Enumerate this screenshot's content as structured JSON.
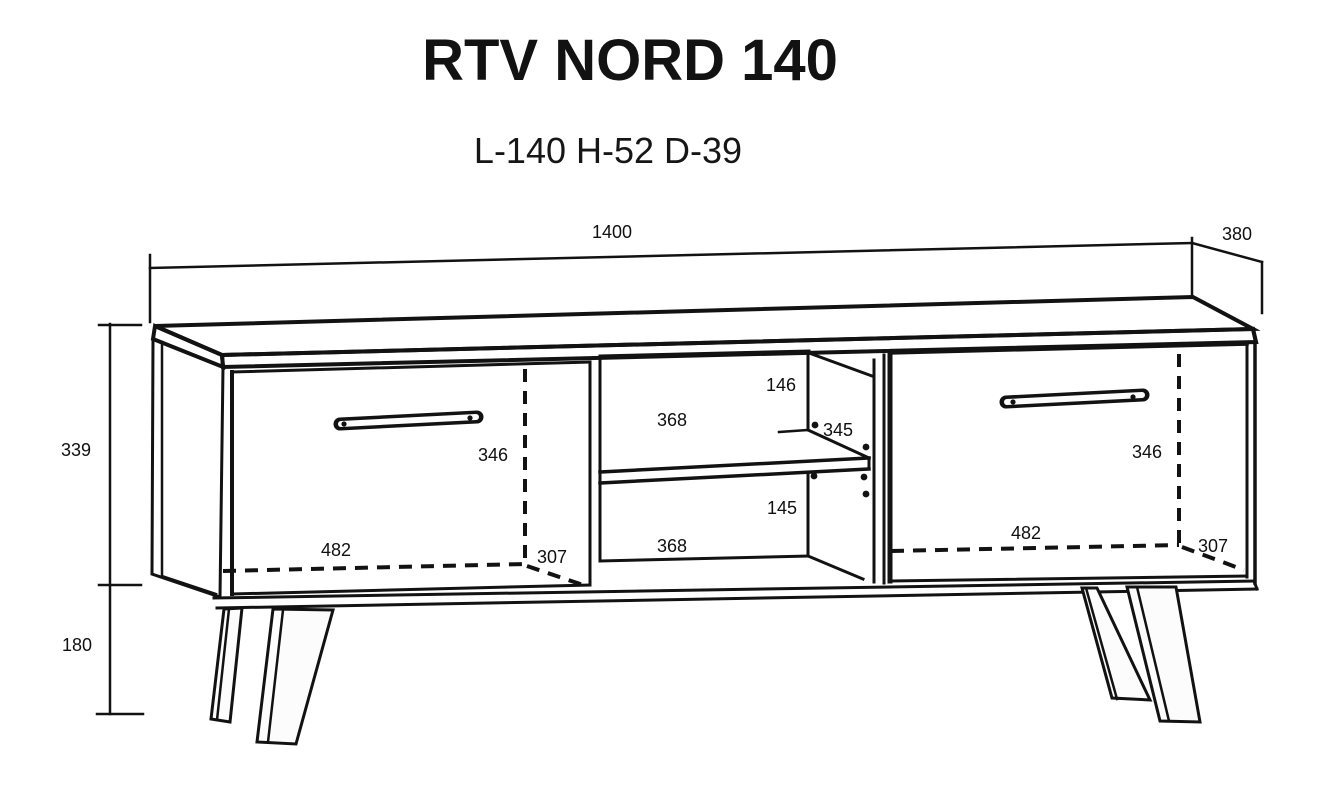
{
  "title": "RTV NORD 140",
  "subtitle": "L-140 H-52 D-39",
  "colors": {
    "line": "#121212",
    "background": "#fcfcfc"
  },
  "dimensions": {
    "total_width_mm": "1400",
    "total_depth_mm": "380",
    "body_height_mm": "339",
    "leg_height_mm": "180"
  },
  "left_door": {
    "width_mm": "482",
    "height_mm": "346",
    "diagonal_mm": "307"
  },
  "right_door": {
    "width_mm": "482",
    "height_mm": "346",
    "diagonal_mm": "307"
  },
  "middle_section": {
    "upper_opening_height_mm": "146",
    "upper_opening_width_mm": "368",
    "shelf_depth_mm": "345",
    "lower_opening_height_mm": "145",
    "lower_opening_width_mm": "368"
  }
}
